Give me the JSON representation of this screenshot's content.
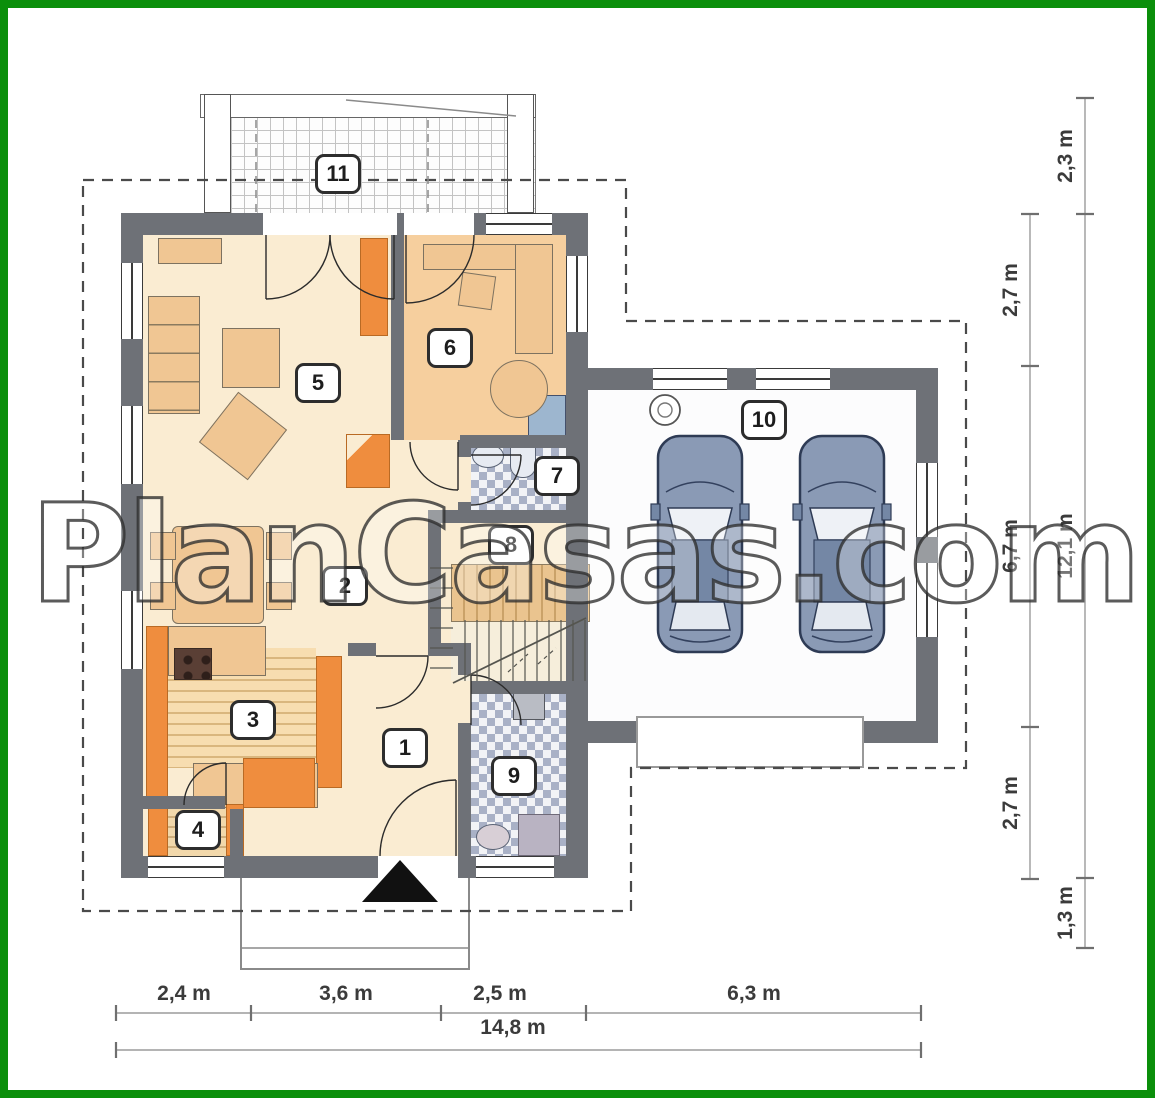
{
  "watermark": {
    "text": "PlanCasas.com"
  },
  "rooms": [
    "1",
    "2",
    "3",
    "4",
    "5",
    "6",
    "7",
    "8",
    "9",
    "10",
    "11"
  ],
  "dimensions": {
    "bottom_segments": [
      "2,4 m",
      "3,6 m",
      "2,5 m",
      "6,3 m"
    ],
    "bottom_total": "14,8 m",
    "right_inner": [
      "2,7 m",
      "6,7 m",
      "2,7 m"
    ],
    "right_outer": [
      "2,3 m",
      "12,1 m",
      "1,3 m"
    ]
  },
  "colors": {
    "frame_green": "#0b8f0b",
    "wall_gray": "#6e7177",
    "floor_cream": "#faecd2",
    "room6_floor": "#f6cf9e",
    "accent_orange": "#ef8d3e",
    "furniture_tan": "#f0c693",
    "car_blue": "#8a9ab5",
    "bath_checker": "#a9b1c6"
  }
}
